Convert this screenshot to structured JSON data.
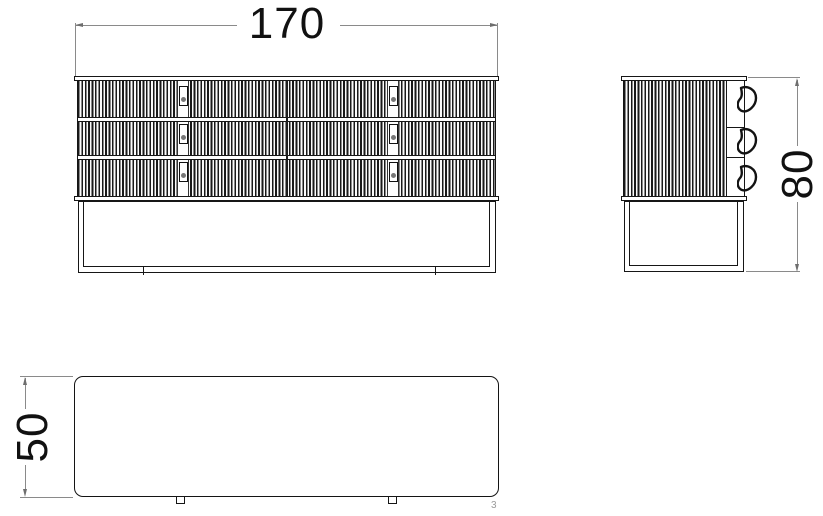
{
  "drawing": {
    "front_view": {
      "width_dimension": "170"
    },
    "side_view": {
      "height_dimension": "80"
    },
    "top_view": {
      "depth_dimension": "50"
    },
    "page_number": "3"
  },
  "style_colors": {
    "outline": "#161616",
    "dimension_line": "#8a8a8a",
    "dimension_text": "#111111",
    "handle_knob": "#777777",
    "page_number": "#9b9b9b",
    "background": "#ffffff"
  }
}
